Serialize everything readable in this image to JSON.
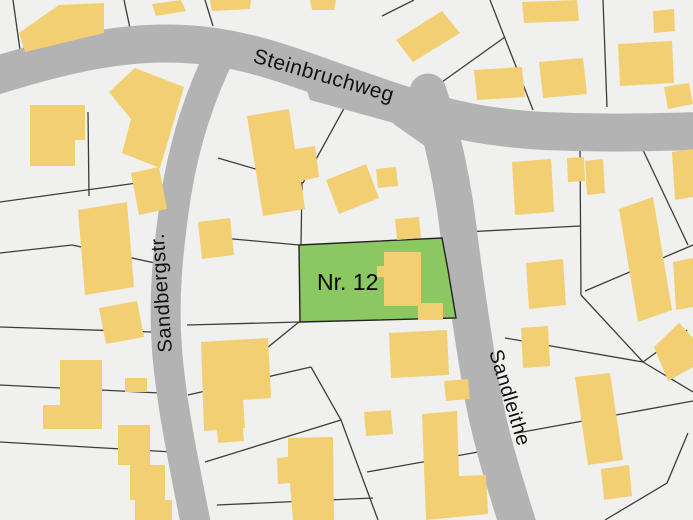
{
  "map": {
    "background_color": "#f0f0ee",
    "road_color": "#b3b3b3",
    "building_color": "#f3cf73",
    "parcel_line_color": "#3c3c3c",
    "highlight_parcel": {
      "label": "Nr. 12",
      "fill": "#8bc862",
      "outline": "#222222",
      "polygon": [
        [
          299,
          245
        ],
        [
          442,
          238
        ],
        [
          448,
          270
        ],
        [
          456,
          318
        ],
        [
          300,
          322
        ]
      ],
      "label_x": 317,
      "label_y": 290,
      "label_font_size": 23
    },
    "streets": [
      {
        "name": "Steinbruchweg",
        "path": "M -12 78 C 70 52, 140 36, 215 47 C 275 56, 320 78, 400 104 C 450 120, 490 128, 545 131 C 610 134, 655 132, 705 131",
        "width": 38,
        "label": {
          "x": 252,
          "y": 62,
          "rotate": 16,
          "font_size": 21
        }
      },
      {
        "name": "Sandbergstr.",
        "path": "M 222 50 C 200 95, 185 140, 176 195 C 168 250, 163 295, 167 350 C 171 400, 181 450, 196 525",
        "width": 30,
        "label": {
          "x": 172,
          "y": 352,
          "rotate": -94,
          "font_size": 20
        }
      },
      {
        "name": "Sandleithe",
        "path": "M 428 92 C 444 140, 453 185, 459 235 C 465 285, 472 330, 481 385 C 490 438, 504 480, 518 525",
        "width": 37,
        "label": {
          "x": 489,
          "y": 352,
          "rotate": 73,
          "font_size": 20
        }
      }
    ],
    "junction_patches": [
      [
        [
          300,
          70
        ],
        [
          435,
          98
        ],
        [
          452,
          160
        ],
        [
          412,
          128
        ],
        [
          310,
          100
        ]
      ],
      [
        [
          370,
          98
        ],
        [
          440,
          113
        ],
        [
          452,
          165
        ],
        [
          395,
          125
        ]
      ]
    ],
    "parcel_lines": [
      [
        [
          13,
          0
        ],
        [
          21,
          57
        ]
      ],
      [
        [
          124,
          0
        ],
        [
          131,
          33
        ]
      ],
      [
        [
          205,
          0
        ],
        [
          213,
          26
        ]
      ],
      [
        [
          382,
          16
        ],
        [
          414,
          0
        ]
      ],
      [
        [
          428,
          92
        ],
        [
          505,
          37
        ]
      ],
      [
        [
          490,
          0
        ],
        [
          533,
          110
        ]
      ],
      [
        [
          603,
          0
        ],
        [
          607,
          107
        ]
      ],
      [
        [
          0,
          202
        ],
        [
          137,
          183
        ],
        [
          167,
          193
        ]
      ],
      [
        [
          0,
          253
        ],
        [
          72,
          245
        ],
        [
          155,
          263
        ]
      ],
      [
        [
          0,
          327
        ],
        [
          152,
          332
        ]
      ],
      [
        [
          0,
          385
        ],
        [
          160,
          393
        ]
      ],
      [
        [
          0,
          442
        ],
        [
          173,
          452
        ]
      ],
      [
        [
          88,
          112
        ],
        [
          89,
          196
        ]
      ],
      [
        [
          218,
          158
        ],
        [
          303,
          183
        ]
      ],
      [
        [
          353,
          92
        ],
        [
          303,
          183
        ]
      ],
      [
        [
          302,
          183
        ],
        [
          301,
          244
        ]
      ],
      [
        [
          200,
          236
        ],
        [
          299,
          245
        ]
      ],
      [
        [
          187,
          325
        ],
        [
          300,
          322
        ]
      ],
      [
        [
          299,
          322
        ],
        [
          225,
          382
        ]
      ],
      [
        [
          188,
          395
        ],
        [
          311,
          367
        ]
      ],
      [
        [
          311,
          367
        ],
        [
          341,
          420
        ],
        [
          378,
          520
        ]
      ],
      [
        [
          205,
          462
        ],
        [
          341,
          420
        ]
      ],
      [
        [
          217,
          505
        ],
        [
          373,
          498
        ]
      ],
      [
        [
          367,
          472
        ],
        [
          478,
          452
        ]
      ],
      [
        [
          465,
          232
        ],
        [
          580,
          226
        ]
      ],
      [
        [
          580,
          148
        ],
        [
          581,
          295
        ]
      ],
      [
        [
          643,
          150
        ],
        [
          688,
          245
        ]
      ],
      [
        [
          693,
          245
        ],
        [
          585,
          291
        ]
      ],
      [
        [
          581,
          295
        ],
        [
          643,
          362
        ]
      ],
      [
        [
          505,
          338
        ],
        [
          643,
          362
        ]
      ],
      [
        [
          643,
          362
        ],
        [
          687,
          330
        ]
      ],
      [
        [
          643,
          362
        ],
        [
          693,
          392
        ]
      ],
      [
        [
          517,
          433
        ],
        [
          693,
          401
        ]
      ],
      [
        [
          605,
          520
        ],
        [
          667,
          483
        ],
        [
          688,
          433
        ]
      ]
    ],
    "buildings": [
      [
        [
          19,
          33
        ],
        [
          59,
          5
        ],
        [
          104,
          3
        ],
        [
          104,
          33
        ],
        [
          25,
          52
        ]
      ],
      [
        [
          152,
          4
        ],
        [
          181,
          0
        ],
        [
          186,
          11
        ],
        [
          156,
          16
        ]
      ],
      [
        [
          210,
          0
        ],
        [
          251,
          0
        ],
        [
          250,
          9
        ],
        [
          212,
          11
        ]
      ],
      [
        [
          310,
          0
        ],
        [
          336,
          0
        ],
        [
          334,
          10
        ],
        [
          312,
          10
        ]
      ],
      [
        [
          396,
          40
        ],
        [
          442,
          11
        ],
        [
          460,
          33
        ],
        [
          413,
          62
        ]
      ],
      [
        [
          522,
          2
        ],
        [
          577,
          0
        ],
        [
          579,
          21
        ],
        [
          524,
          23
        ]
      ],
      [
        [
          474,
          70
        ],
        [
          522,
          67
        ],
        [
          525,
          97
        ],
        [
          477,
          100
        ]
      ],
      [
        [
          539,
          62
        ],
        [
          583,
          58
        ],
        [
          587,
          94
        ],
        [
          543,
          98
        ]
      ],
      [
        [
          653,
          11
        ],
        [
          674,
          9
        ],
        [
          675,
          31
        ],
        [
          654,
          33
        ]
      ],
      [
        [
          618,
          44
        ],
        [
          672,
          41
        ],
        [
          674,
          83
        ],
        [
          620,
          86
        ]
      ],
      [
        [
          664,
          87
        ],
        [
          689,
          83
        ],
        [
          693,
          104
        ],
        [
          668,
          109
        ]
      ],
      [
        [
          30,
          105
        ],
        [
          85,
          105
        ],
        [
          85,
          140
        ],
        [
          75,
          140
        ],
        [
          75,
          166
        ],
        [
          30,
          166
        ]
      ],
      [
        [
          109,
          92
        ],
        [
          135,
          68
        ],
        [
          184,
          87
        ],
        [
          160,
          168
        ],
        [
          122,
          153
        ],
        [
          131,
          119
        ]
      ],
      [
        [
          131,
          173
        ],
        [
          159,
          167
        ],
        [
          167,
          209
        ],
        [
          139,
          215
        ]
      ],
      [
        [
          78,
          210
        ],
        [
          127,
          202
        ],
        [
          134,
          287
        ],
        [
          85,
          295
        ]
      ],
      [
        [
          99,
          308
        ],
        [
          137,
          301
        ],
        [
          144,
          337
        ],
        [
          106,
          344
        ]
      ],
      [
        [
          60,
          360
        ],
        [
          102,
          360
        ],
        [
          102,
          429
        ],
        [
          43,
          429
        ],
        [
          43,
          405
        ],
        [
          60,
          405
        ]
      ],
      [
        [
          125,
          378
        ],
        [
          147,
          378
        ],
        [
          147,
          392
        ],
        [
          125,
          392
        ]
      ],
      [
        [
          118,
          425
        ],
        [
          150,
          425
        ],
        [
          150,
          465
        ],
        [
          165,
          465
        ],
        [
          165,
          500
        ],
        [
          172,
          500
        ],
        [
          172,
          520
        ],
        [
          135,
          520
        ],
        [
          135,
          500
        ],
        [
          130,
          500
        ],
        [
          130,
          465
        ],
        [
          118,
          465
        ]
      ],
      [
        [
          247,
          116
        ],
        [
          289,
          109
        ],
        [
          295,
          149
        ],
        [
          315,
          146
        ],
        [
          319,
          177
        ],
        [
          301,
          181
        ],
        [
          305,
          209
        ],
        [
          263,
          216
        ]
      ],
      [
        [
          198,
          222
        ],
        [
          230,
          218
        ],
        [
          234,
          255
        ],
        [
          202,
          259
        ]
      ],
      [
        [
          326,
          180
        ],
        [
          366,
          164
        ],
        [
          379,
          198
        ],
        [
          339,
          214
        ]
      ],
      [
        [
          376,
          169
        ],
        [
          396,
          167
        ],
        [
          398,
          186
        ],
        [
          378,
          188
        ]
      ],
      [
        [
          395,
          219
        ],
        [
          419,
          217
        ],
        [
          421,
          238
        ],
        [
          397,
          240
        ]
      ],
      [
        [
          384,
          252
        ],
        [
          421,
          252
        ],
        [
          421,
          306
        ],
        [
          384,
          306
        ],
        [
          384,
          277
        ],
        [
          377,
          277
        ],
        [
          377,
          266
        ],
        [
          384,
          266
        ]
      ],
      [
        [
          418,
          303
        ],
        [
          443,
          303
        ],
        [
          443,
          320
        ],
        [
          418,
          320
        ]
      ],
      [
        [
          389,
          333
        ],
        [
          447,
          330
        ],
        [
          449,
          375
        ],
        [
          391,
          378
        ]
      ],
      [
        [
          444,
          381
        ],
        [
          468,
          379
        ],
        [
          470,
          399
        ],
        [
          446,
          401
        ]
      ],
      [
        [
          364,
          412
        ],
        [
          391,
          410
        ],
        [
          393,
          434
        ],
        [
          366,
          436
        ]
      ],
      [
        [
          422,
          414
        ],
        [
          457,
          411
        ],
        [
          459,
          476
        ],
        [
          486,
          475
        ],
        [
          488,
          514
        ],
        [
          426,
          520
        ]
      ],
      [
        [
          201,
          342
        ],
        [
          268,
          338
        ],
        [
          271,
          398
        ],
        [
          243,
          400
        ],
        [
          245,
          428
        ],
        [
          204,
          431
        ]
      ],
      [
        [
          216,
          421
        ],
        [
          242,
          419
        ],
        [
          244,
          441
        ],
        [
          218,
          443
        ]
      ],
      [
        [
          288,
          438
        ],
        [
          333,
          437
        ],
        [
          334,
          520
        ],
        [
          293,
          520
        ],
        [
          290,
          483
        ],
        [
          278,
          484
        ],
        [
          277,
          458
        ],
        [
          288,
          457
        ]
      ],
      [
        [
          512,
          162
        ],
        [
          551,
          159
        ],
        [
          554,
          212
        ],
        [
          515,
          215
        ]
      ],
      [
        [
          567,
          158
        ],
        [
          584,
          157
        ],
        [
          585,
          181
        ],
        [
          568,
          182
        ]
      ],
      [
        [
          585,
          161
        ],
        [
          603,
          159
        ],
        [
          605,
          193
        ],
        [
          587,
          195
        ]
      ],
      [
        [
          619,
          209
        ],
        [
          653,
          197
        ],
        [
          672,
          310
        ],
        [
          638,
          322
        ]
      ],
      [
        [
          673,
          262
        ],
        [
          693,
          258
        ],
        [
          693,
          307
        ],
        [
          676,
          310
        ]
      ],
      [
        [
          654,
          347
        ],
        [
          679,
          323
        ],
        [
          693,
          338
        ],
        [
          693,
          367
        ],
        [
          668,
          381
        ]
      ],
      [
        [
          526,
          263
        ],
        [
          563,
          259
        ],
        [
          566,
          305
        ],
        [
          529,
          309
        ]
      ],
      [
        [
          521,
          328
        ],
        [
          548,
          326
        ],
        [
          550,
          366
        ],
        [
          523,
          368
        ]
      ],
      [
        [
          575,
          377
        ],
        [
          610,
          373
        ],
        [
          623,
          460
        ],
        [
          588,
          465
        ]
      ],
      [
        [
          601,
          469
        ],
        [
          629,
          465
        ],
        [
          632,
          496
        ],
        [
          604,
          500
        ]
      ],
      [
        [
          672,
          152
        ],
        [
          693,
          149
        ],
        [
          693,
          197
        ],
        [
          675,
          200
        ]
      ]
    ]
  }
}
